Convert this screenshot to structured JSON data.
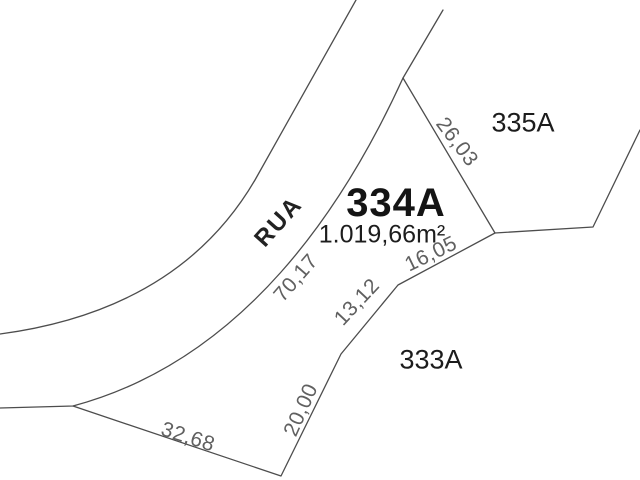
{
  "drawing_type": "cadastral lot survey plan",
  "street": {
    "name": "RUA"
  },
  "main_lot": {
    "id": "334A",
    "area": "1.019,66m²"
  },
  "adjacent_lots": {
    "northeast": "335A",
    "southeast": "333A"
  },
  "dimensions": {
    "north_side": "26,03",
    "east_upper": "16,05",
    "east_middle": "13,12",
    "east_lower": "20,00",
    "south_side": "32,68",
    "street_frontage": "70,17"
  },
  "colors": {
    "background": "#ffffff",
    "boundary_line": "#4d4d4d",
    "dimension_text": "#606060",
    "lot_text": "#1c1c1c"
  }
}
